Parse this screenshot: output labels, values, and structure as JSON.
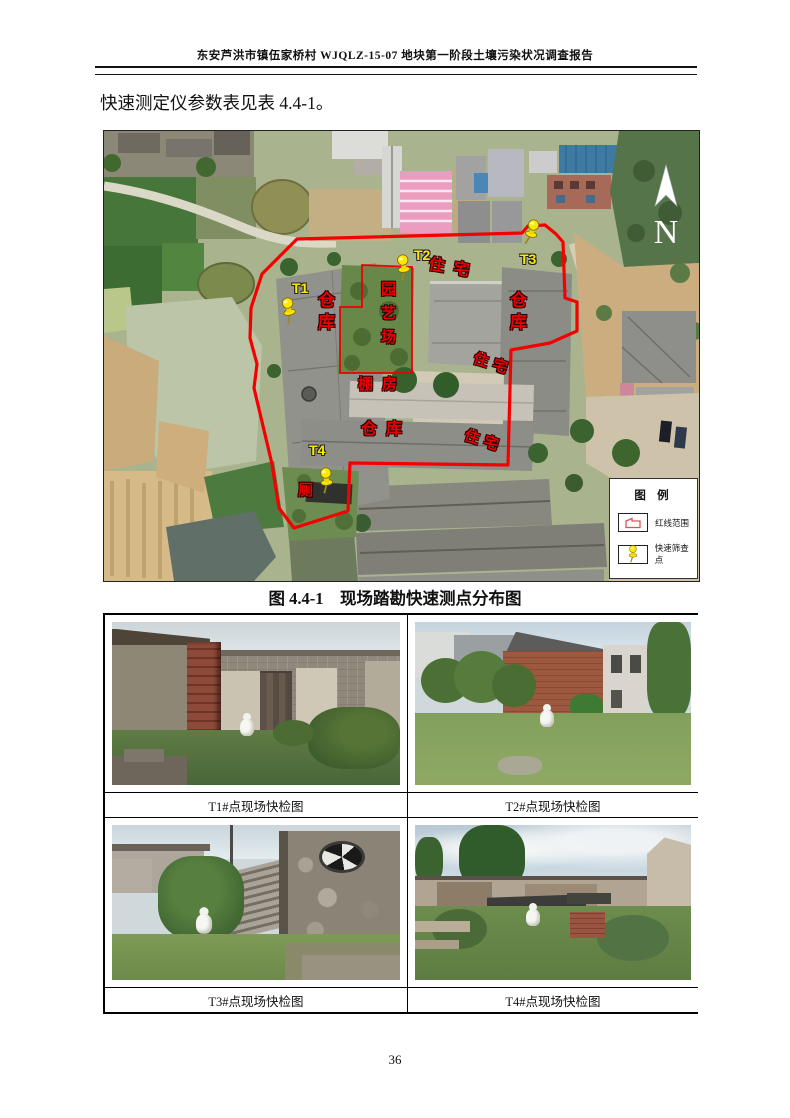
{
  "page": {
    "header": "东安芦洪市镇伍家桥村 WJQLZ-15-07 地块第一阶段土壤污染状况调查报告",
    "body_text": "快速测定仪参数表见表 4.4-1。",
    "figure_caption": "图 4.4-1　现场踏勘快速测点分布图",
    "page_number": "36"
  },
  "map": {
    "north_label": "N",
    "labels": {
      "t1": "T1",
      "t2": "T2",
      "t3": "T3",
      "t4": "T4",
      "warehouse_left": "仓库",
      "warehouse_right": "仓库",
      "warehouse_bottom": "仓库",
      "residence_top": "住宅",
      "residence_right_upper": "住宅",
      "residence_right_lower": "住宅",
      "garden": "园艺场",
      "shed": "棚房",
      "toilet": "厕"
    },
    "legend": {
      "title": "图 例",
      "items": [
        {
          "label": "红线范围"
        },
        {
          "label": "快速筛查点"
        }
      ]
    },
    "colors": {
      "boundary_red": "#f50000",
      "pin_yellow": "#ffe800",
      "label_red": "#e80000",
      "label_yellow": "#ffeb00"
    }
  },
  "photos": [
    {
      "caption": "T1#点现场快检图"
    },
    {
      "caption": "T2#点现场快检图"
    },
    {
      "caption": "T3#点现场快检图"
    },
    {
      "caption": "T4#点现场快检图"
    }
  ]
}
